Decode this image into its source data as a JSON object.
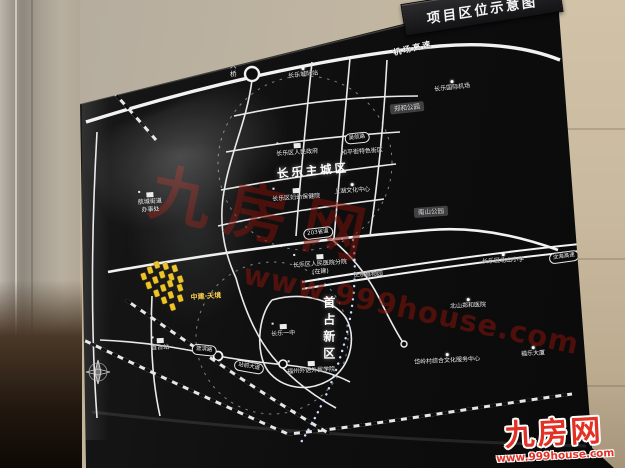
{
  "banner": {
    "title": "项目区位示意图"
  },
  "watermark": {
    "brand": "九房网",
    "url": "www.999house.com"
  },
  "logo": {
    "name": "九房网",
    "url": "www.999house.com"
  },
  "colors": {
    "accent_red": "#e23125",
    "board_black": "#0e0e0e",
    "wall_beige": "#c2b49b",
    "project_yellow": "#f0c322",
    "road_white": "#f2f2f2"
  },
  "map": {
    "labels": [
      {
        "name": "road-label-airport-expressway",
        "t": "机场高速",
        "type": "roadname",
        "x": 413,
        "y": 49,
        "r": -13
      },
      {
        "name": "road-label-yingqian-bridge",
        "t": "营前大桥",
        "type": "roadname-v",
        "x": 232,
        "y": 62,
        "r": 0
      },
      {
        "name": "district-label-changle-main-city",
        "t": "长乐主城区",
        "type": "district",
        "x": 313,
        "y": 171,
        "r": -5
      },
      {
        "name": "poi-changle-district-government",
        "t": "长乐区人民政府",
        "type": "poi",
        "x": 297,
        "y": 150,
        "r": -4,
        "m": "bld"
      },
      {
        "name": "poi-heping-street-block",
        "t": "和平街特色街区",
        "type": "poi",
        "x": 362,
        "y": 152,
        "r": -4
      },
      {
        "name": "poi-shanghu-culture-center",
        "t": "上湖文化中心",
        "type": "poi",
        "x": 352,
        "y": 189,
        "r": -4,
        "m": "dot"
      },
      {
        "name": "poi-changle-maternity-hospital",
        "t": "长乐区妇幼保健院",
        "type": "poi",
        "x": 296,
        "y": 195,
        "r": -4,
        "m": "bld"
      },
      {
        "name": "road-badge-wuhang-road",
        "t": "吴航路",
        "type": "badge",
        "x": 357,
        "y": 138,
        "r": -6
      },
      {
        "name": "poi-nanshan-park",
        "t": "南山公园",
        "type": "boxlabel",
        "x": 431,
        "y": 212,
        "r": -4
      },
      {
        "name": "poi-zhenghe-park",
        "t": "郑和公园",
        "type": "boxlabel",
        "x": 407,
        "y": 108,
        "r": -6
      },
      {
        "name": "poi-changle-international-airport",
        "t": "长乐国际机场",
        "type": "poi",
        "x": 452,
        "y": 86,
        "r": -6,
        "m": "dot"
      },
      {
        "name": "poi-changle-intercity-station",
        "t": "长乐城际站",
        "type": "poi",
        "x": 303,
        "y": 73,
        "r": -6,
        "m": "dot"
      },
      {
        "name": "poi-beishan-primary-school",
        "t": "长乐区北山小学",
        "type": "poi",
        "x": 503,
        "y": 259,
        "r": -3,
        "m": "dot"
      },
      {
        "name": "road-badge-provincial-road-203",
        "t": "203省道",
        "type": "badge",
        "x": 318,
        "y": 233,
        "r": -7
      },
      {
        "name": "poi-peoples-hospital-branch",
        "t": "长乐区人民医院分院\n(在建)",
        "type": "poi2",
        "x": 320,
        "y": 265,
        "r": -4,
        "m": "bld"
      },
      {
        "name": "poi-changle-botanical-garden",
        "t": "长乐植物园",
        "type": "poi",
        "x": 368,
        "y": 275,
        "r": -4
      },
      {
        "name": "district-label-shouzhan-new-district",
        "t": "首占新区",
        "type": "district-v",
        "x": 328,
        "y": 330,
        "r": 0
      },
      {
        "name": "poi-changle-no1-middle-school",
        "t": "长乐一中",
        "type": "poi",
        "x": 283,
        "y": 331,
        "r": -3,
        "m": "bld"
      },
      {
        "name": "poi-fuzhou-foreign-studies-college",
        "t": "福州外语外贸学院",
        "type": "poi",
        "x": 311,
        "y": 368,
        "r": -3,
        "m": "bld"
      },
      {
        "name": "poi-beishan-zhenghe-hospital",
        "t": "北山郑和医院",
        "type": "poi",
        "x": 468,
        "y": 304,
        "r": -3,
        "m": "dot"
      },
      {
        "name": "poi-dailing-culture-service-center",
        "t": "岱岭村综合文化服务中心",
        "type": "poi",
        "x": 447,
        "y": 359,
        "r": -3,
        "m": "dot"
      },
      {
        "name": "poi-fule-tower",
        "t": "福乐大厦",
        "type": "poi",
        "x": 533,
        "y": 352,
        "r": -3,
        "m": "dot"
      },
      {
        "name": "poi-hangcheng-street-office",
        "t": "航城街道\n办事处",
        "type": "poi2",
        "x": 150,
        "y": 203,
        "r": -4,
        "m": "bld"
      },
      {
        "name": "poi-shouzhan-station",
        "t": "首占站",
        "type": "poi",
        "x": 160,
        "y": 345,
        "r": -3,
        "m": "bld"
      },
      {
        "name": "road-badge-zhanqian-avenue",
        "t": "站前大道",
        "type": "badge",
        "x": 249,
        "y": 367,
        "r": 10
      },
      {
        "name": "road-badge-yingbin-road",
        "t": "营滨路",
        "type": "badge",
        "x": 204,
        "y": 350,
        "r": 6
      },
      {
        "name": "road-badge-shenhai-expressway",
        "t": "沈海高速",
        "type": "badge",
        "x": 564,
        "y": 257,
        "r": -8
      },
      {
        "name": "project-name-label",
        "t": "中建·天境",
        "type": "project",
        "x": 206,
        "y": 297,
        "r": -4
      }
    ]
  }
}
